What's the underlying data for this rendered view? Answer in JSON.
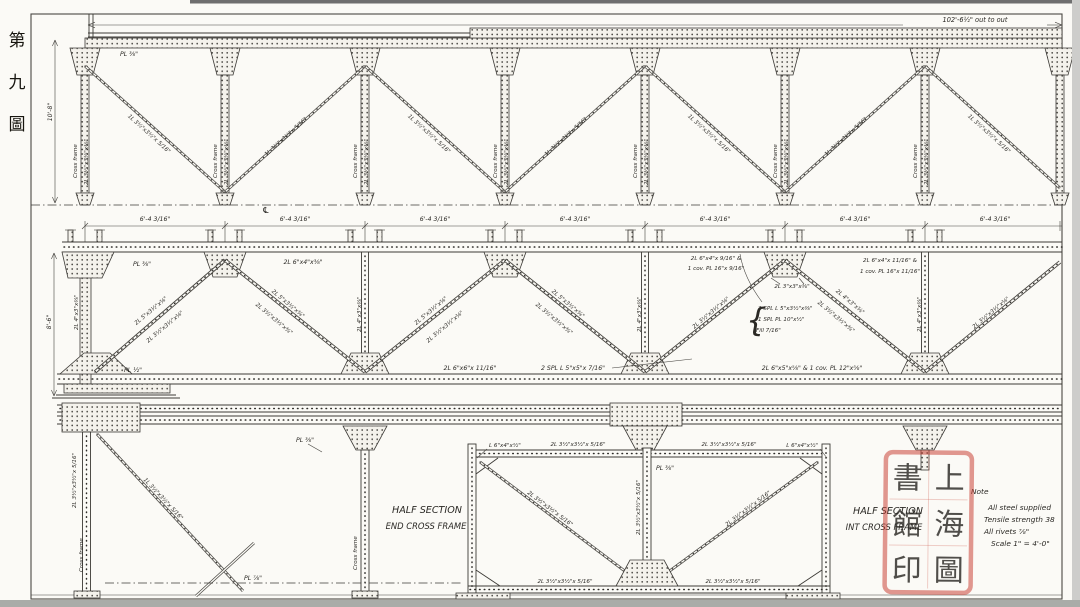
{
  "figure_caption": {
    "chars": [
      "第",
      "九",
      "圖"
    ]
  },
  "top_plan": {
    "overall_dim": "102'-6½\" out to out",
    "height_dim": "10'-8\"",
    "plate": "PL ⅜\"",
    "post_name": "Cross frame",
    "post_section": "2L 3½\"x3½\"x⅜\"",
    "diagonal_section": "1L 3½\"x3½\"x 5/16\"",
    "centerline": "℄"
  },
  "panel_dim": "6'-4 3/16\"",
  "elevation": {
    "height_dim": "8'-6\"",
    "plate_top": "PL ⅜\"",
    "plate_bottom": "PL ½\"",
    "top_chord_a": "2L 6\"x4\"x⅜\"",
    "top_chord_b1": "2L 6\"x4\"x 9/16\" &",
    "top_chord_b2": "1 cov. PL 16\"x 9/16\"",
    "top_chord_c1": "2L 6\"x4\"x 11/16\" &",
    "top_chord_c2": "1 cov. PL 16\"x 11/16\"",
    "diag_main": "2L 5\"x3½\"x⅜\"",
    "diag_secondary": "2L 3½\"x3½\"x⅜\"",
    "diag_minor": "2L 4\"x3\"x⅜\"",
    "vertical_section": "2L 4\"x3\"x⅜\"",
    "apex_tie": "2L 3\"x3\"x⅜\"",
    "splice_1": "2 SPL L 5\"x3½\"x⅜\"",
    "splice_2": "1 SPL PL 10\"x½\"",
    "splice_3": "Fill 7/16\"",
    "bottom_chord_a": "2L 6\"x6\"x 11/16\"",
    "bottom_chord_b": "2 SPL L 5\"x5\"x 7/16\"",
    "bottom_chord_c": "2L 6\"x5\"x⅝\" & 1 cov. PL 12\"x⅝\""
  },
  "end_frame": {
    "title_1": "HALF SECTION",
    "title_2": "END CROSS FRAME",
    "post_name": "Cross frame",
    "post_section": "2L 3½\"x3½\"x 5/16\"",
    "diag_section": "1L 3½\"x3½\"x 5/16\"",
    "plate_a": "PL ⅜\"",
    "plate_b": "PL ⅞\""
  },
  "int_frame": {
    "title_1": "HALF SECTION",
    "title_2": "INT CROSS FRAME",
    "corner_angle": "L 6\"x4\"x½\"",
    "chord_section": "2L 3½\"x3½\"x 5/16\"",
    "diag_section": "2L 3½\"x3½\"x 5/16\"",
    "post_section": "2L 3½\"x3½\"x 5/16\"",
    "plate": "PL ⅜\""
  },
  "note": {
    "title": "Note",
    "lines": [
      "All steel supplied",
      "Tensile strength 38",
      "All rivets ⅞\"",
      "Scale 1\" = 4'-0\""
    ]
  },
  "seal": {
    "chars": [
      "上",
      "海",
      "圖",
      "書",
      "館",
      "印"
    ]
  }
}
